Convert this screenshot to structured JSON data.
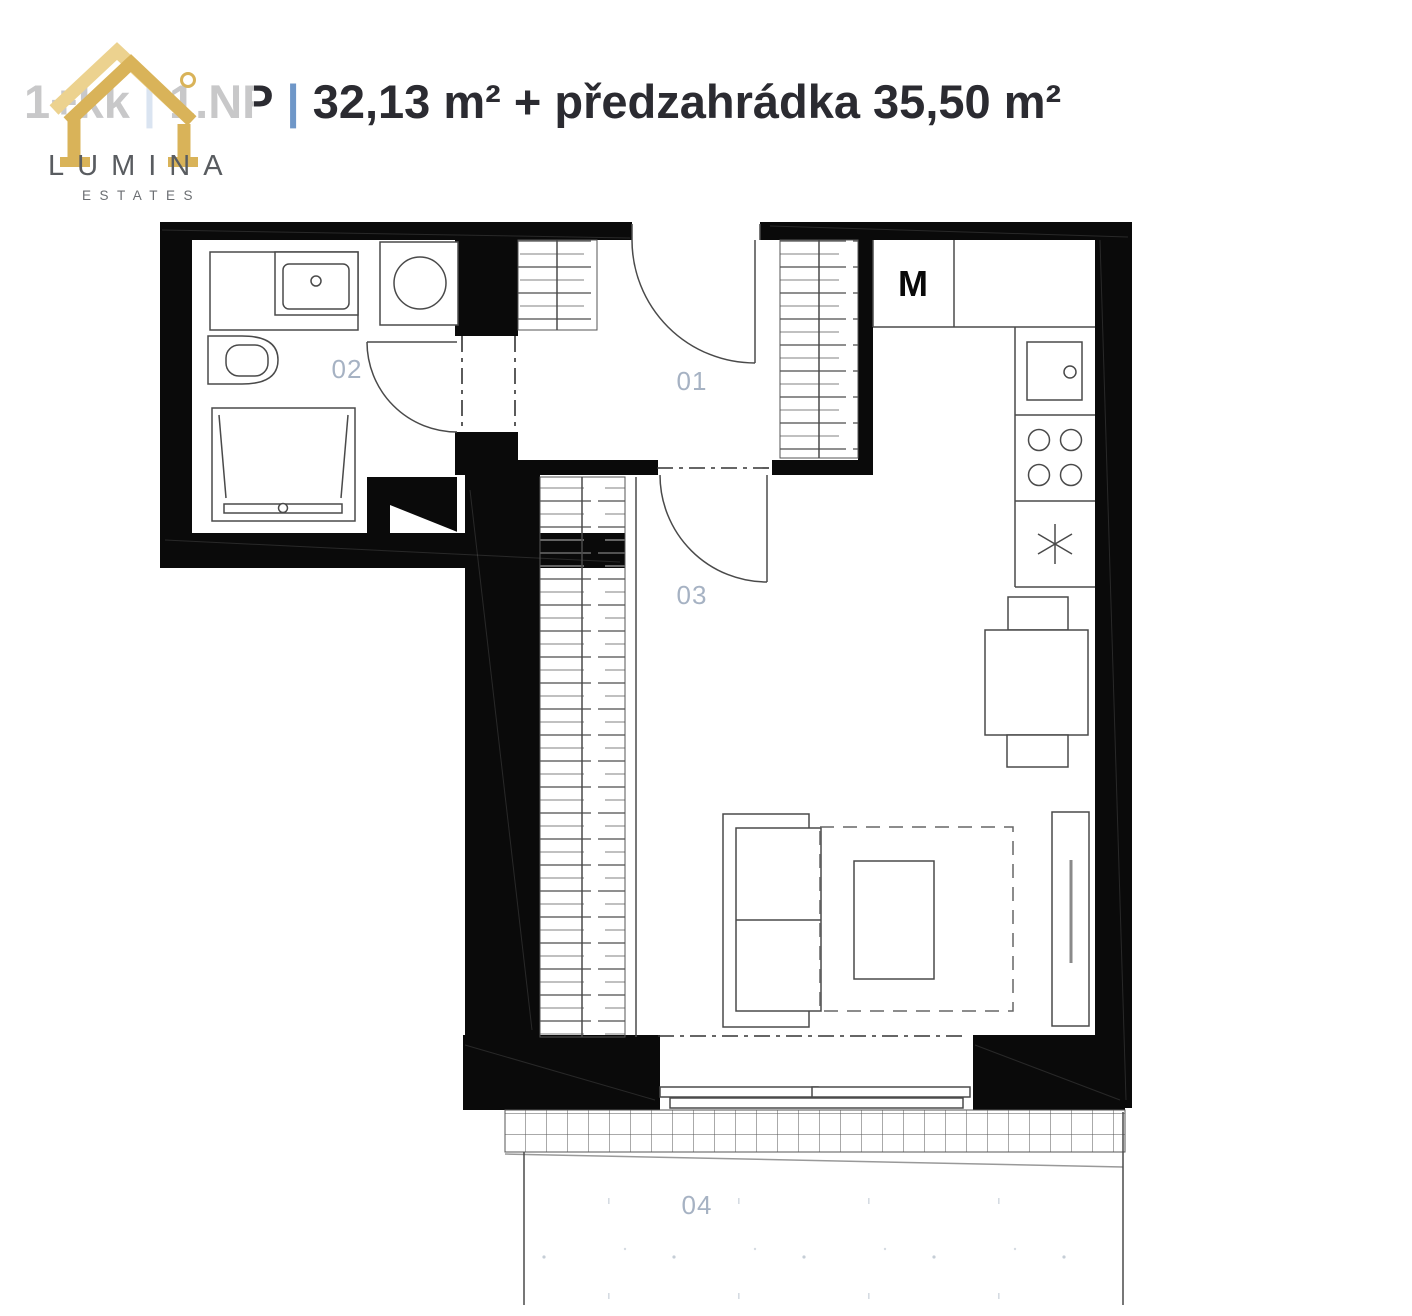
{
  "header": {
    "unit_type": "1+kk",
    "separator": "|",
    "floor": "1.NP",
    "area": "32,13 m² + předzahrádka 35,50 m²",
    "colors": {
      "title": "#2b2b31",
      "separator": "#6f97c8"
    }
  },
  "logo": {
    "name": "LUMINA",
    "tagline": "ESTATES",
    "colors": {
      "gold": "#d9b359",
      "gold_light": "#ecd28f",
      "text": "#595c60"
    }
  },
  "floor_plan": {
    "labels": {
      "room_01": "01",
      "room_02": "02",
      "room_03": "03",
      "room_04": "04",
      "appliance_m": "M"
    },
    "label_color": "#a6b2c3",
    "wall_color": "#0a0a0a"
  }
}
